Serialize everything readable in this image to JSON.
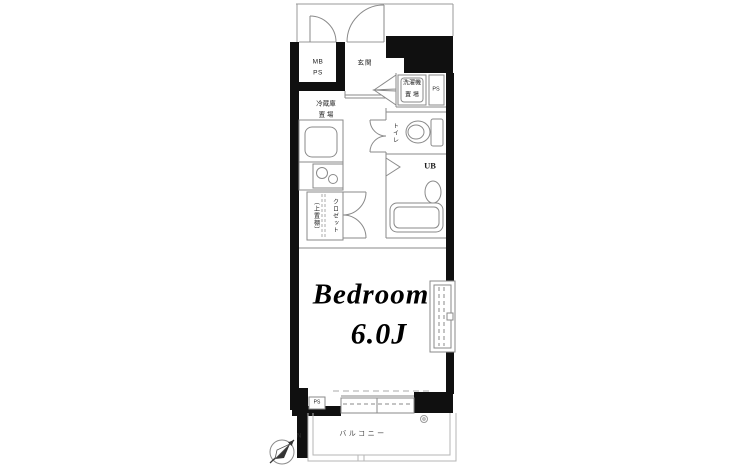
{
  "colors": {
    "wall": "#101010",
    "line": "#8a8a8a",
    "line_light": "#b5b5b5",
    "text": "#1c1c1c",
    "background": "#ffffff"
  },
  "labels": {
    "meter_box": {
      "line1": "MB",
      "line2": "PS"
    },
    "entrance": "玄関",
    "washer": {
      "line1": "洗濯機",
      "line2": "置 場"
    },
    "ps_top": "PS",
    "fridge": {
      "line1": "冷蔵庫",
      "line2": "置 場"
    },
    "toilet": "トイレ",
    "unit_bath": "UB",
    "closet": "クロゼット",
    "closet_note": "（上置棚）",
    "ps_bottom": "PS",
    "bedroom": {
      "name": "Bedroom",
      "size": "6.0J"
    },
    "balcony": "バルコニー",
    "compass_north": "N"
  }
}
